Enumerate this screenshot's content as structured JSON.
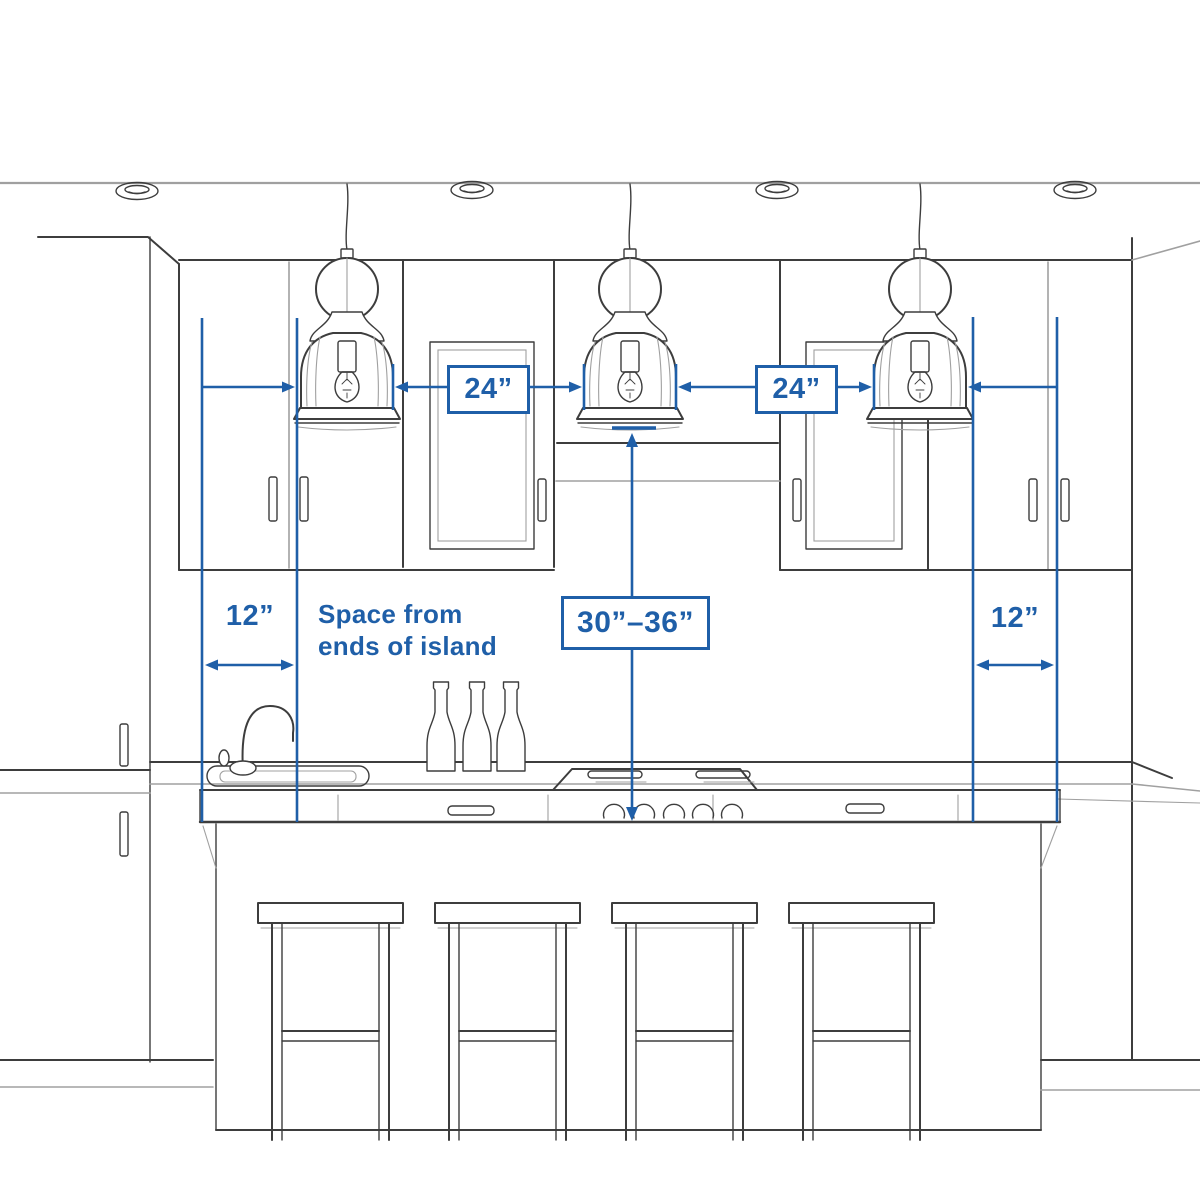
{
  "diagram": {
    "type": "kitchen-island-pendant-spacing-diagram",
    "colors": {
      "dimension_blue": "#1f5fa8",
      "sketch_dark": "#3d3d3d",
      "sketch_light": "#a0a0a0",
      "background": "#ffffff"
    },
    "dimensions": {
      "pendant_spacing_left": "24”",
      "pendant_spacing_right": "24”",
      "island_end_space_left": "12”",
      "island_end_space_right": "12”",
      "pendant_height_above_counter": "30”–36”"
    },
    "note": {
      "line1": "Space from",
      "line2": "ends of island"
    },
    "objects": {
      "pendant_count": 3,
      "recessed_light_count": 4,
      "bar_stool_count": 4,
      "bottle_count": 3,
      "cooktop_knob_count": 5
    }
  }
}
